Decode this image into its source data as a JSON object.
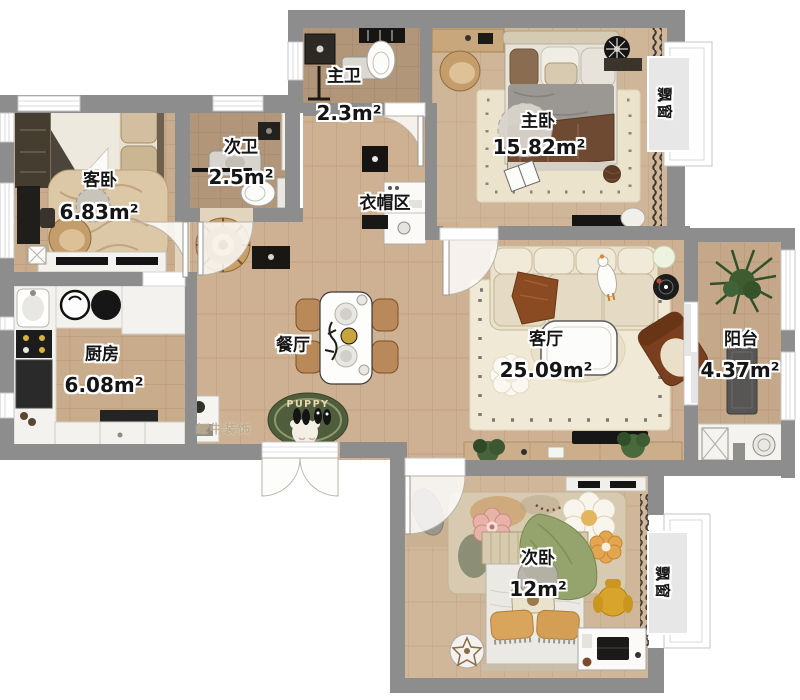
{
  "plan": {
    "rooms": [
      {
        "id": "master-bath",
        "name": "主卫",
        "area": "2.3m²"
      },
      {
        "id": "master-bedroom",
        "name": "主卧",
        "area": "15.82m²"
      },
      {
        "id": "second-bath",
        "name": "次卫",
        "area": "2.5m²"
      },
      {
        "id": "guest-bedroom",
        "name": "客卧",
        "area": "6.83m²"
      },
      {
        "id": "cloakroom",
        "name": "衣帽区",
        "area": ""
      },
      {
        "id": "kitchen",
        "name": "厨房",
        "area": "6.08m²"
      },
      {
        "id": "dining",
        "name": "餐厅",
        "area": ""
      },
      {
        "id": "living",
        "name": "客厅",
        "area": "25.09m²"
      },
      {
        "id": "balcony",
        "name": "阳台",
        "area": "4.37m²"
      },
      {
        "id": "second-bedroom",
        "name": "次卧",
        "area": "12m²"
      }
    ],
    "bay_window_label": "飘窗",
    "entry_rug_text": "PUPPY",
    "watermark": "红牛装饰",
    "colors": {
      "wall": "#8d8d8d",
      "wood": "#cdb192",
      "bath_floor": "#b2967a",
      "living_rug": "#f0e9d6",
      "entry_rug_green": "#4f5d3c"
    }
  }
}
